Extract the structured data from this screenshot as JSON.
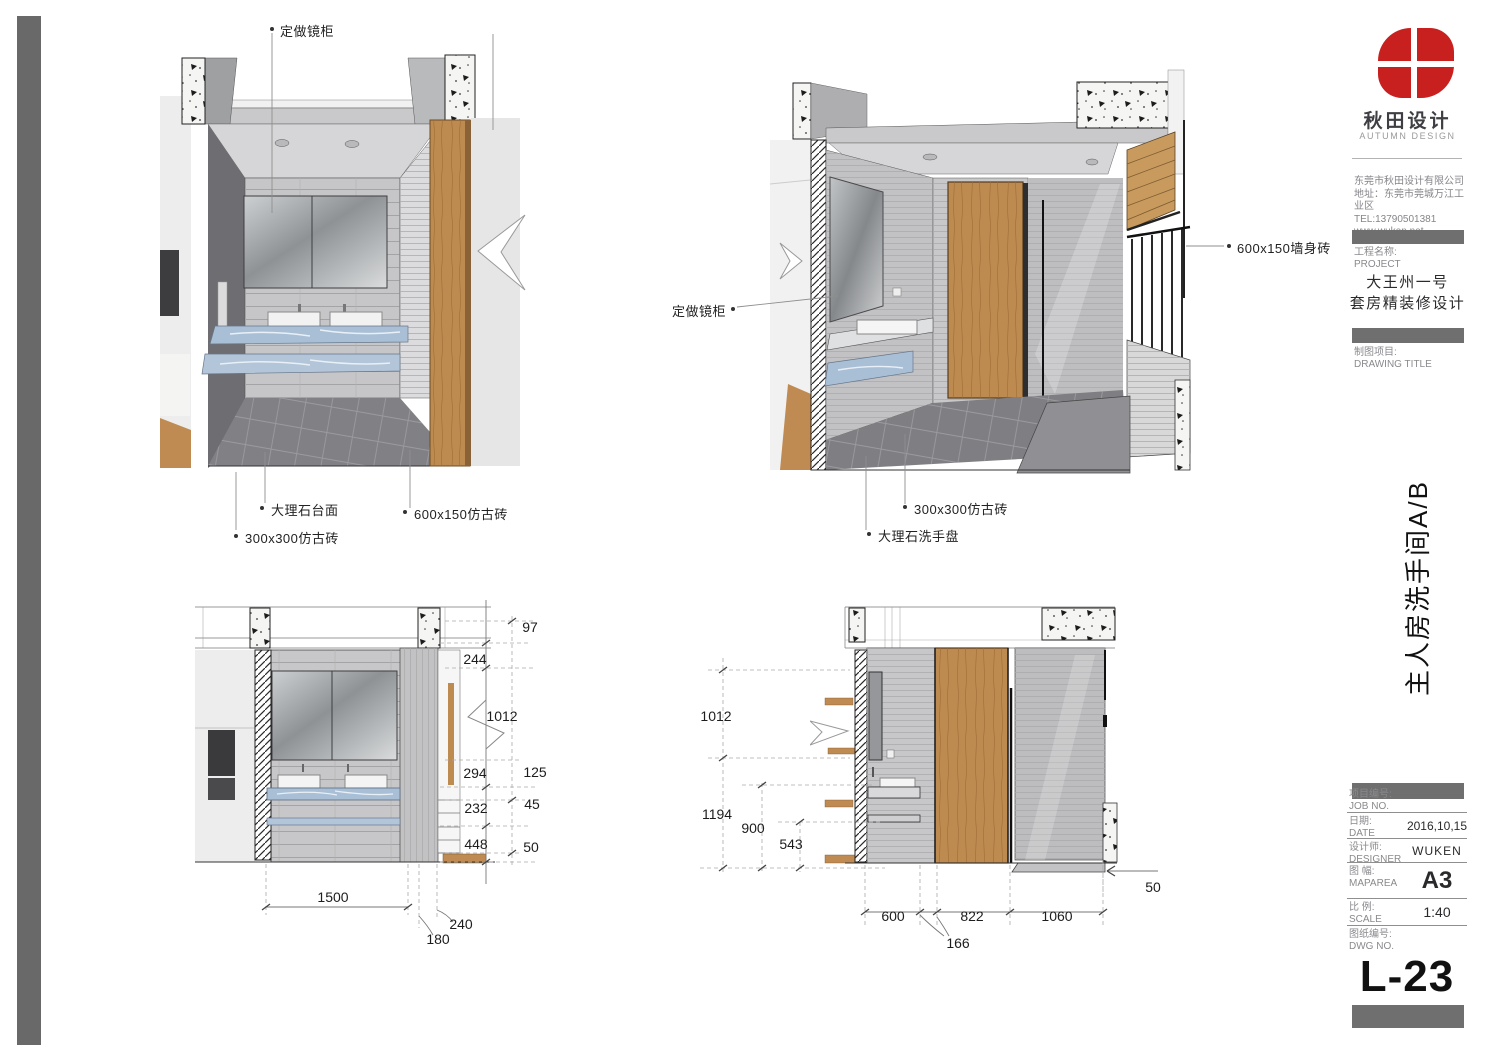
{
  "sidebar": {
    "brand": {
      "cn": "秋田设计",
      "en": "AUTUMN DESIGN",
      "logo_color": "#c8201f"
    },
    "company": {
      "name": "东莞市秋田设计有限公司",
      "address": "地址：东莞市莞城万江工业区",
      "tel": "TEL:13790501381",
      "website": "www.wuken.net"
    },
    "project": {
      "label_cn": "工程名称:",
      "label_en": "PROJECT",
      "name_line1": "大王州一号",
      "name_line2": "套房精装修设计"
    },
    "drawing": {
      "label_cn": "制图项目:",
      "label_en": "DRAWING TITLE",
      "vertical_title": "主人房洗手间A/B"
    },
    "table": {
      "job": {
        "label_cn": "项目编号:",
        "label_en": "JOB NO.",
        "value": ""
      },
      "date": {
        "label_cn": "日期:",
        "label_en": "DATE",
        "value": "2016,10,15"
      },
      "designer": {
        "label_cn": "设计师:",
        "label_en": "DESIGNER",
        "value": "WUKEN"
      },
      "maparea": {
        "label_cn": "图 幅:",
        "label_en": "MAPAREA",
        "value": "A3"
      },
      "scale": {
        "label_cn": "比 例:",
        "label_en": "SCALE",
        "value": "1:40"
      },
      "dwg": {
        "label_cn": "图纸编号:",
        "label_en": "DWG NO.",
        "value": "L-23"
      }
    }
  },
  "annotations": {
    "view_a": {
      "mirror_cabinet": "定做镜柜",
      "marble_counter": "大理石台面",
      "wall_tile": "600x150仿古砖",
      "floor_tile": "300x300仿古砖"
    },
    "view_b": {
      "mirror_cabinet": "定做镜柜",
      "wall_tile": "600x150墙身砖",
      "floor_tile": "300x300仿古砖",
      "marble_basin": "大理石洗手盘"
    }
  },
  "dims": {
    "a": {
      "d97": "97",
      "d244": "244",
      "d1012": "1012",
      "d294": "294",
      "d125": "125",
      "d232": "232",
      "d45": "45",
      "d448": "448",
      "d50": "50",
      "d1500": "1500",
      "d240": "240",
      "d180": "180"
    },
    "b": {
      "d1012": "1012",
      "d1194": "1194",
      "d900": "900",
      "d543": "543",
      "d600": "600",
      "d822": "822",
      "d1060": "1060",
      "d166": "166",
      "d50": "50"
    }
  }
}
